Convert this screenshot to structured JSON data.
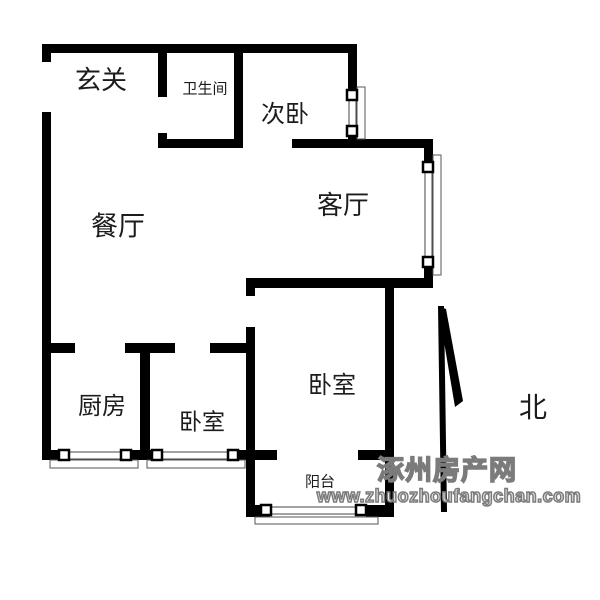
{
  "floorplan": {
    "rooms": [
      {
        "id": "entry",
        "label": "玄关"
      },
      {
        "id": "bathroom",
        "label": "卫生间"
      },
      {
        "id": "bedroom-second",
        "label": "次卧"
      },
      {
        "id": "dining-room",
        "label": "餐厅"
      },
      {
        "id": "living-room",
        "label": "客厅"
      },
      {
        "id": "kitchen",
        "label": "厨房"
      },
      {
        "id": "bedroom-small",
        "label": "卧室"
      },
      {
        "id": "bedroom-main",
        "label": "卧室"
      },
      {
        "id": "balcony",
        "label": "阳台"
      }
    ],
    "compass": {
      "label": "北"
    },
    "watermark": {
      "site_name": "涿州房产网",
      "site_url": "www.zhuozhoufangchan.com"
    },
    "colors": {
      "wall": "#000000",
      "background": "#ffffff",
      "watermark_outline": "#7b7b7b",
      "label": "#1c1c1c"
    }
  }
}
